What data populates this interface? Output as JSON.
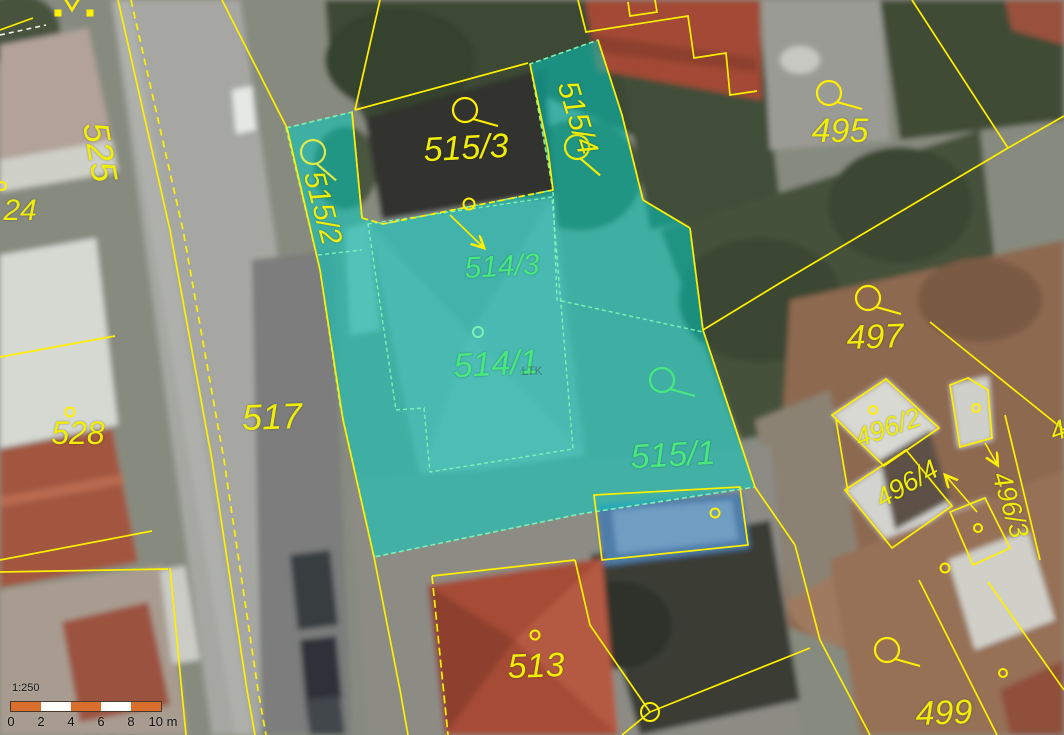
{
  "map": {
    "title": "cadastral-map-with-orthophoto",
    "colors": {
      "boundary_yellow": "#ffef00",
      "label_yellow": "#f0ed08",
      "selected_green": "#49e87f",
      "highlight_teal": "#00cfc3",
      "footprint_mint": "#7df0b4",
      "white_boundary": "#f2f2ea"
    },
    "watermark": "LTK",
    "parcels": [
      {
        "text": "24",
        "x": 20,
        "y": 211,
        "rot": 0,
        "fs": 30,
        "kind": "normal"
      },
      {
        "text": "525",
        "x": 100,
        "y": 152,
        "rot": 80,
        "fs": 36,
        "kind": "normal"
      },
      {
        "text": "515/3",
        "x": 466,
        "y": 148,
        "rot": -3,
        "fs": 34,
        "kind": "normal"
      },
      {
        "text": "515/2",
        "x": 322,
        "y": 208,
        "rot": 75,
        "fs": 30,
        "kind": "normal"
      },
      {
        "text": "515/4",
        "x": 577,
        "y": 118,
        "rot": 73,
        "fs": 30,
        "kind": "normal"
      },
      {
        "text": "517",
        "x": 272,
        "y": 417,
        "rot": -2,
        "fs": 36,
        "kind": "normal"
      },
      {
        "text": "528",
        "x": 78,
        "y": 433,
        "rot": 0,
        "fs": 32,
        "kind": "normal"
      },
      {
        "text": "513",
        "x": 536,
        "y": 666,
        "rot": -2,
        "fs": 34,
        "kind": "normal"
      },
      {
        "text": "495",
        "x": 840,
        "y": 131,
        "rot": 0,
        "fs": 34,
        "kind": "normal"
      },
      {
        "text": "497",
        "x": 875,
        "y": 337,
        "rot": -2,
        "fs": 34,
        "kind": "normal"
      },
      {
        "text": "499",
        "x": 944,
        "y": 713,
        "rot": -2,
        "fs": 34,
        "kind": "normal"
      },
      {
        "text": "496/2",
        "x": 888,
        "y": 428,
        "rot": -20,
        "fs": 27,
        "kind": "normal"
      },
      {
        "text": "496/4",
        "x": 907,
        "y": 484,
        "rot": -30,
        "fs": 27,
        "kind": "normal"
      },
      {
        "text": "496/3",
        "x": 1010,
        "y": 505,
        "rot": 73,
        "fs": 27,
        "kind": "normal"
      },
      {
        "text": "4",
        "x": 1058,
        "y": 431,
        "rot": -20,
        "fs": 27,
        "kind": "normal"
      },
      {
        "text": "529",
        "x": 110,
        "y": 749,
        "rot": 0,
        "fs": 36,
        "kind": "normal"
      },
      {
        "text": "514/3",
        "x": 502,
        "y": 267,
        "rot": -3,
        "fs": 30,
        "kind": "selected"
      },
      {
        "text": "514/1",
        "x": 496,
        "y": 364,
        "rot": -3,
        "fs": 34,
        "kind": "selected"
      },
      {
        "text": "515/1",
        "x": 673,
        "y": 455,
        "rot": -3,
        "fs": 34,
        "kind": "selected"
      },
      {
        "text": "LTK",
        "x": 532,
        "y": 371,
        "rot": 0,
        "fs": 12,
        "kind": "watermark"
      }
    ],
    "symbols": [
      {
        "name": "parcel-loop-icon",
        "type": "loop",
        "x": 465,
        "y": 110,
        "rot": 0,
        "c": "#ffef00"
      },
      {
        "name": "parcel-loop-icon",
        "type": "loop",
        "x": 313,
        "y": 152,
        "rot": 25,
        "c": "#e0e84a"
      },
      {
        "name": "parcel-loop-icon",
        "type": "loop",
        "x": 577,
        "y": 147,
        "rot": 25,
        "c": "#f0ed08"
      },
      {
        "name": "parcel-loop-icon",
        "type": "loop",
        "x": 829,
        "y": 93,
        "rot": 0,
        "c": "#ffef00"
      },
      {
        "name": "parcel-loop-icon",
        "type": "loop",
        "x": 868,
        "y": 298,
        "rot": 0,
        "c": "#ffef00"
      },
      {
        "name": "parcel-loop-icon",
        "type": "loop",
        "x": 887,
        "y": 650,
        "rot": 0,
        "c": "#ffef00"
      },
      {
        "name": "parcel-loop-icon",
        "type": "loop",
        "x": 662,
        "y": 380,
        "rot": 0,
        "c": "#49e87f"
      },
      {
        "name": "boundary-dot-icon",
        "type": "dot",
        "x": 70,
        "y": 412,
        "r": 4.5,
        "c": "#ffef00"
      },
      {
        "name": "boundary-dot-icon",
        "type": "dot",
        "x": 535,
        "y": 635,
        "r": 4.5,
        "c": "#ffef00"
      },
      {
        "name": "boundary-dot-icon",
        "type": "dot",
        "x": 715,
        "y": 513,
        "r": 4.5,
        "c": "#ffef00"
      },
      {
        "name": "boundary-dot-icon",
        "type": "dot",
        "x": 1003,
        "y": 673,
        "r": 4,
        "c": "#ffef00"
      },
      {
        "name": "boundary-dot-icon",
        "type": "dot",
        "x": 873,
        "y": 410,
        "r": 4,
        "c": "#ffef00"
      },
      {
        "name": "boundary-dot-icon",
        "type": "dot",
        "x": 976,
        "y": 408,
        "r": 4,
        "c": "#ffef00"
      },
      {
        "name": "boundary-dot-icon",
        "type": "dot",
        "x": 978,
        "y": 528,
        "r": 4,
        "c": "#ffef00"
      },
      {
        "name": "boundary-dot-icon",
        "type": "dot",
        "x": 945,
        "y": 568,
        "r": 4.5,
        "c": "#ffef00"
      },
      {
        "name": "boundary-dot-icon",
        "type": "dot",
        "x": 2,
        "y": 186,
        "r": 4,
        "c": "#ffef00"
      },
      {
        "name": "boundary-dot-icon",
        "type": "dot",
        "x": 469,
        "y": 204,
        "r": 5.5,
        "c": "#ffef00"
      },
      {
        "name": "boundary-dot-icon",
        "type": "dot",
        "x": 478,
        "y": 332,
        "r": 5,
        "c": "#7df0b4"
      },
      {
        "name": "survey-square-icon",
        "type": "square",
        "x": 58,
        "y": 13,
        "c": "#ffef00"
      },
      {
        "name": "survey-square-icon",
        "type": "square",
        "x": 90,
        "y": 13,
        "c": "#ffef00"
      },
      {
        "name": "chevron-icon",
        "type": "chevron",
        "x": 72,
        "y": 2,
        "c": "#ffef00"
      },
      {
        "name": "junction-circle-icon",
        "type": "ring",
        "x": 650,
        "y": 712,
        "r": 9,
        "c": "#ffef00"
      },
      {
        "name": "reference-arrow-icon",
        "type": "arrow",
        "x": 450,
        "y": 215,
        "x2": 483,
        "y2": 247,
        "c": "#ffef00"
      },
      {
        "name": "reference-arrow-icon",
        "type": "arrow",
        "x": 985,
        "y": 443,
        "x2": 997,
        "y2": 464,
        "c": "#ffef00"
      },
      {
        "name": "reference-arrow-icon",
        "type": "arrow",
        "x": 977,
        "y": 512,
        "x2": 946,
        "y2": 476,
        "c": "#ffef00"
      }
    ]
  },
  "scalebar": {
    "ratio": "1:250",
    "segment_colors": [
      "#d96e2d",
      "#ffffff",
      "#d96e2d",
      "#ffffff",
      "#d96e2d"
    ],
    "ticks": [
      {
        "t": "0",
        "x": 11
      },
      {
        "t": "2",
        "x": 41
      },
      {
        "t": "4",
        "x": 71
      },
      {
        "t": "6",
        "x": 101
      },
      {
        "t": "8",
        "x": 131
      },
      {
        "t": "10 m",
        "x": 163
      }
    ]
  }
}
